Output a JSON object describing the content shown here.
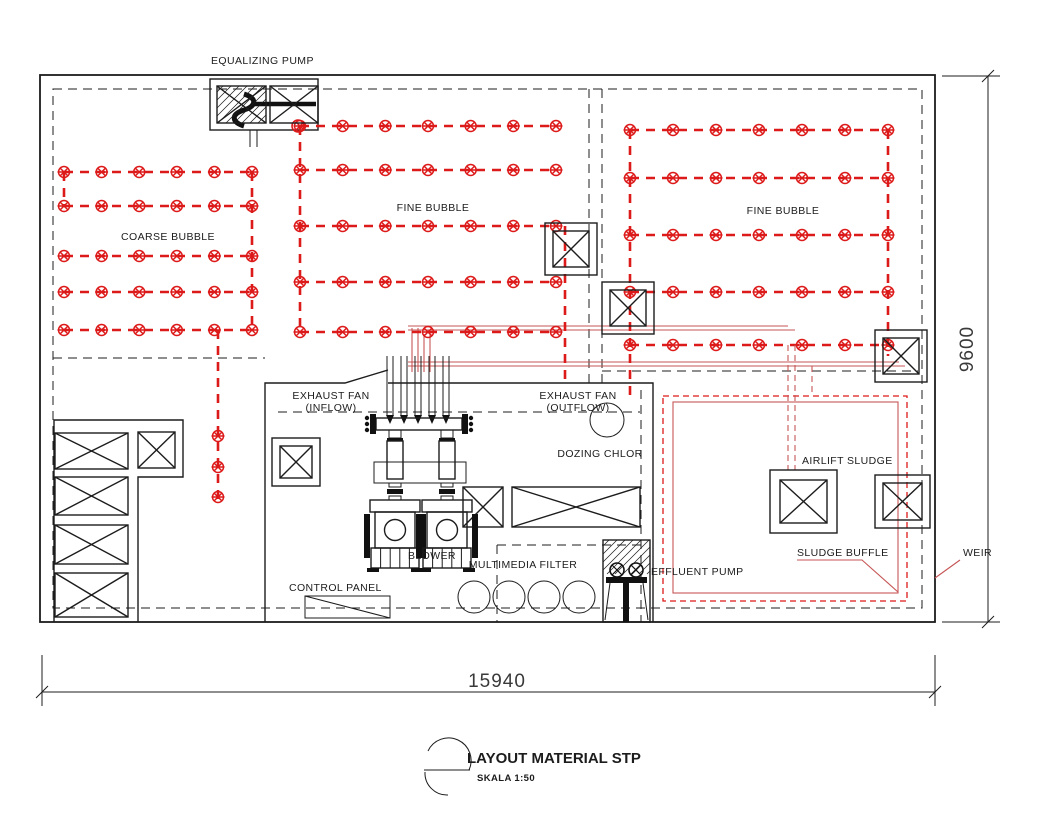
{
  "drawing": {
    "labels": {
      "equalizing_pump": "EQUALIZING PUMP",
      "fine_bubble_left": "FINE BUBBLE",
      "fine_bubble_right": "FINE BUBBLE",
      "coarse_bubble": "COARSE BUBBLE",
      "exhaust_fan_inflow_line1": "EXHAUST FAN",
      "exhaust_fan_inflow_line2": "(INFLOW)",
      "exhaust_fan_outflow_line1": "EXHAUST FAN",
      "exhaust_fan_outflow_line2": "(OUTFLOW)",
      "dozing_chlor": "DOZING CHLOR",
      "airlift_sludge": "AIRLIFT SLUDGE",
      "sludge_buffle": "SLUDGE BUFFLE",
      "weir": "WEIR",
      "control_panel": "CONTROL PANEL",
      "blower": "BLOWER",
      "multimedia_filter": "MULTIMEDIA FILTER",
      "effluent_pump": "EFFLUENT PUMP"
    },
    "dimensions": {
      "width_mm": "15940",
      "height_mm": "9600"
    },
    "title": {
      "name": "LAYOUT MATERIAL STP",
      "scale": "SKALA 1:50"
    },
    "colors": {
      "pipe_red": "#dd1a1a",
      "annotation_red": "#c65555",
      "line_black": "#1c1c1c"
    }
  }
}
